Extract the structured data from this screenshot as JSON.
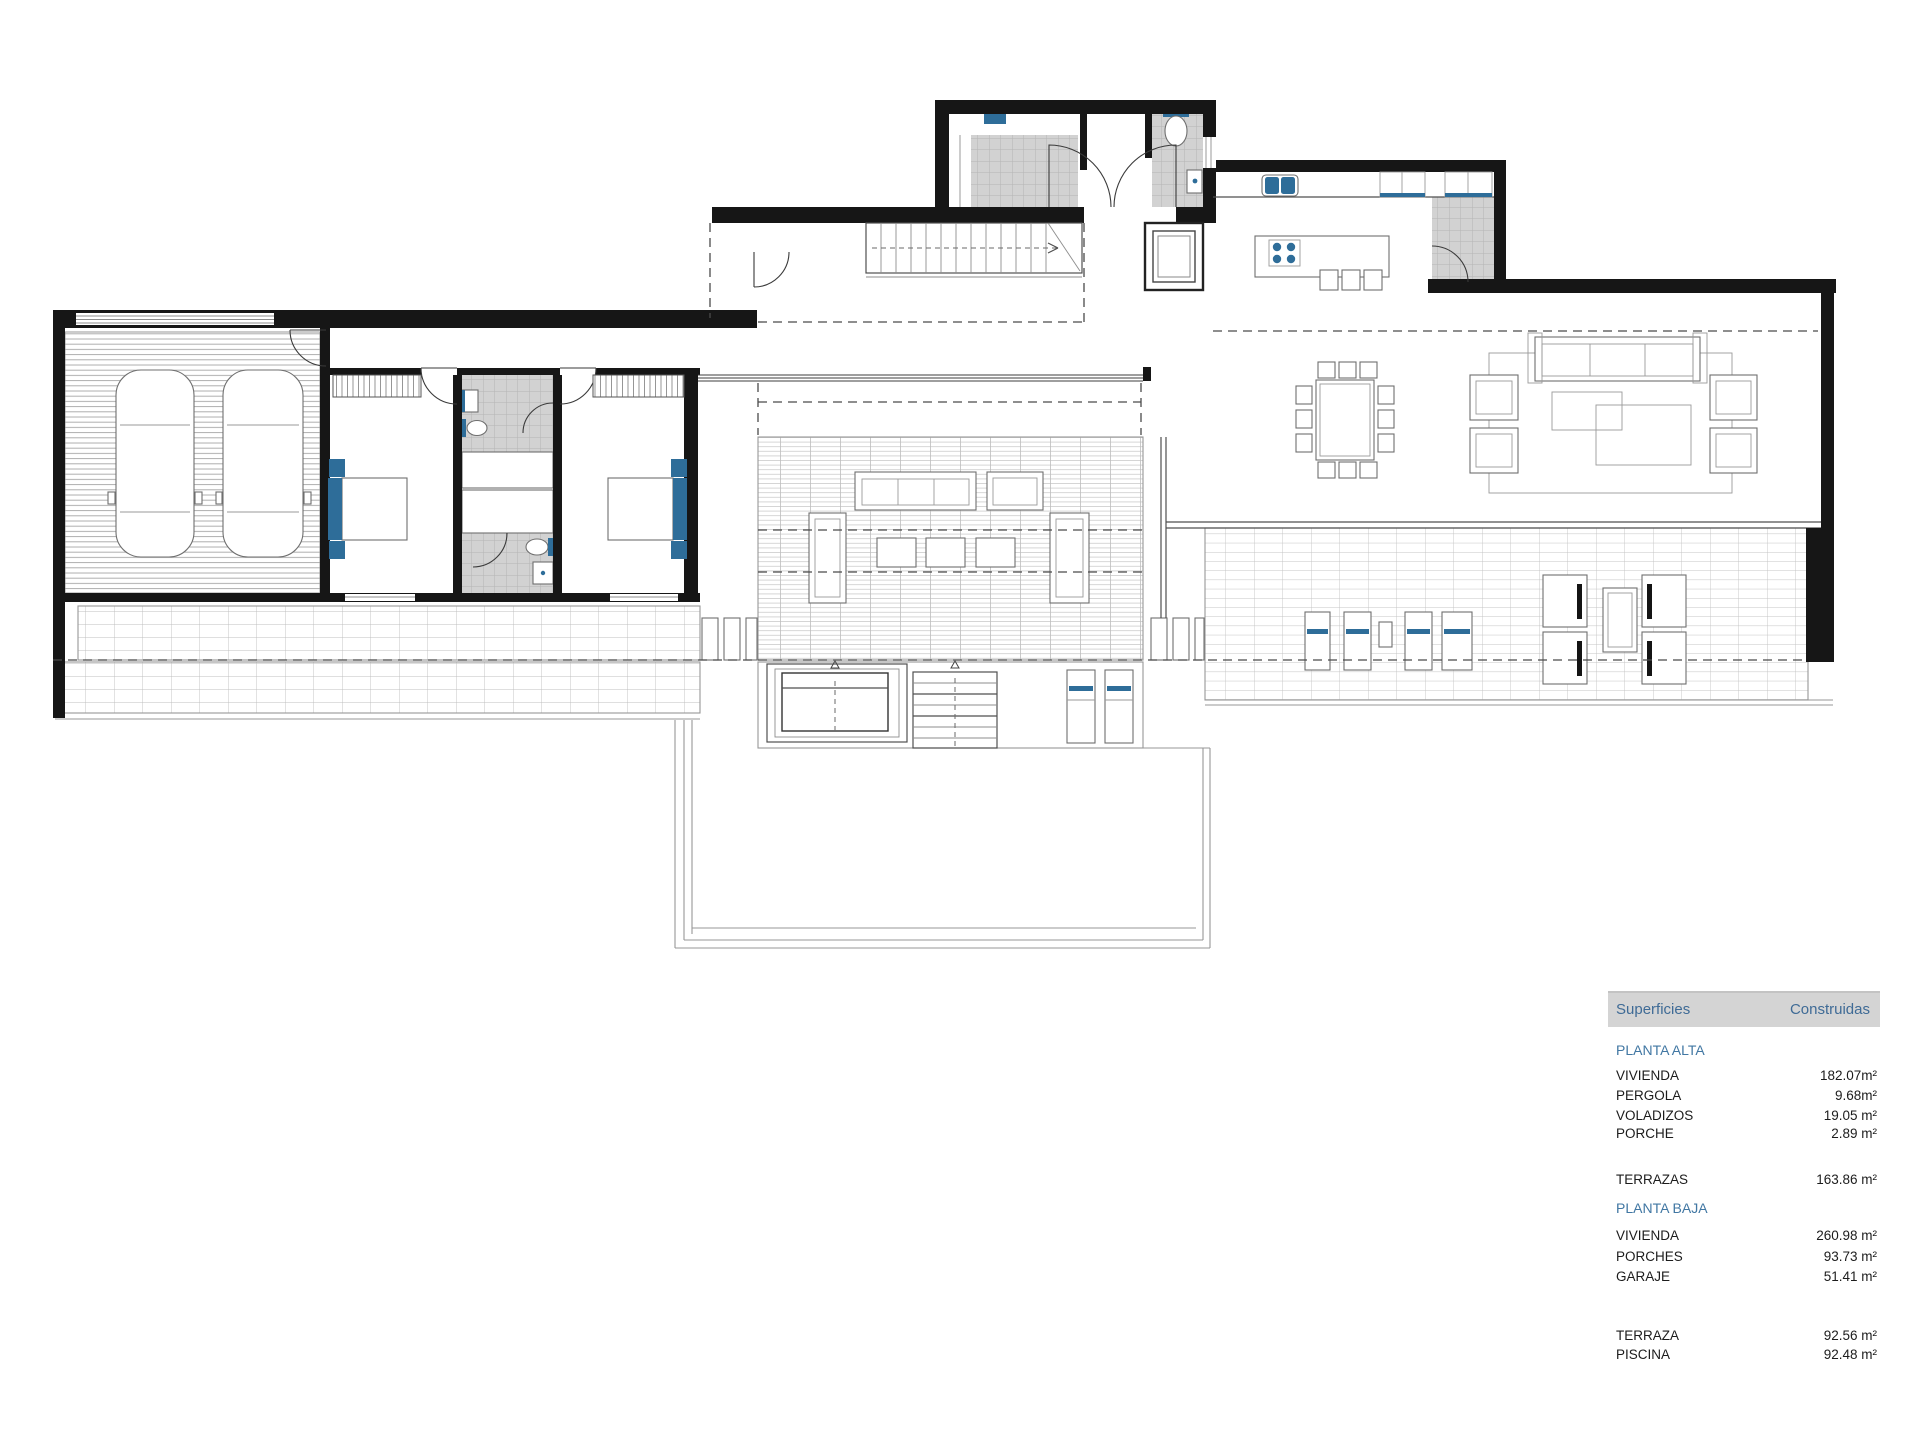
{
  "table": {
    "header": {
      "col1": "Superficies",
      "col2": "Construidas"
    },
    "sections": [
      {
        "title": "PLANTA ALTA",
        "rows": [
          {
            "label": "VIVIENDA",
            "value": "182.07m²"
          },
          {
            "label": "PERGOLA",
            "value": "9.68m²"
          },
          {
            "label": "VOLADIZOS",
            "value": "19.05 m²"
          },
          {
            "label": "PORCHE",
            "value": "2.89 m²"
          }
        ],
        "extra": [
          {
            "label": "TERRAZAS",
            "value": "163.86 m²"
          }
        ]
      },
      {
        "title": "PLANTA BAJA",
        "rows": [
          {
            "label": "VIVIENDA",
            "value": "260.98 m²"
          },
          {
            "label": "PORCHES",
            "value": "93.73 m²"
          },
          {
            "label": "GARAJE",
            "value": "51.41 m²"
          }
        ],
        "extra": [
          {
            "label": "TERRAZA",
            "value": "92.56 m²"
          },
          {
            "label": "PISCINA",
            "value": "92.48 m²"
          }
        ]
      }
    ]
  },
  "colors": {
    "accent_blue": "#2e6d99",
    "table_header_bg": "#d4d4d4",
    "table_header_text": "#3f6b96",
    "section_title_text": "#4177a3",
    "tile_gray": "#d2d2d2"
  }
}
